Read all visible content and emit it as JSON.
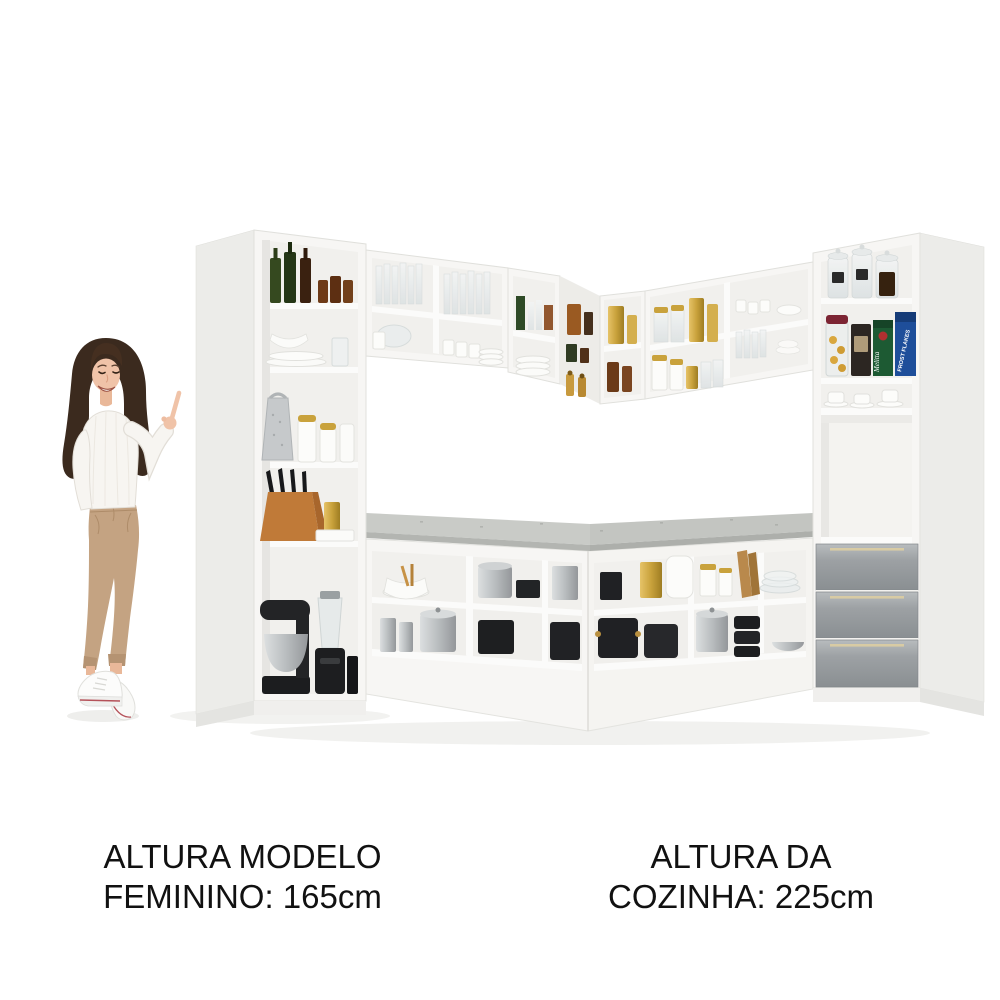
{
  "captions": {
    "model": {
      "line1": "ALTURA MODELO",
      "line2": "FEMININO: 165cm"
    },
    "kitchen": {
      "line1": "ALTURA DA",
      "line2": "COZINHA: 225cm"
    }
  },
  "product_labels": {
    "cereal_box": "FROST FLAKES",
    "coffee_box": "Melitta"
  },
  "colors": {
    "background": "#ffffff",
    "cabinet_white": "#f7f6f4",
    "cabinet_side": "#ecece9",
    "interior": "#f2f1ee",
    "countertop_gray": "#c7c9c5",
    "drawer_gray": "#9aa0a3",
    "handle_gold": "#d8cba4",
    "accent_gold": "#c9a23c",
    "text": "#111111"
  },
  "scene": {
    "type": "product image - L-shaped corner kitchen with open shelves and female model pointing",
    "areas": {
      "left_pantry": [
        "glass bottles",
        "small amber jars",
        "plates and bowls",
        "drinking glass",
        "metal grater",
        "canisters with gold lids",
        "knife block with knives",
        "gold canister",
        "serving tray",
        "stand mixer",
        "blender",
        "black appliance"
      ],
      "wall_cabinets": [
        "drinking glasses",
        "glass bowl",
        "white mugs",
        "stacked plates",
        "amber and green glasses",
        "gold canisters",
        "spice grinders",
        "glass jars with gold lids",
        "white canisters with gold lids"
      ],
      "right_tall_cabinet": [
        "glass storage jars with labels",
        "cookie jar",
        "coffee bag",
        "Melitta coffee box",
        "Frost Flakes cereal box",
        "cups and saucers",
        "open niche",
        "three gray drawers with gold handles"
      ],
      "base_counters": [
        "white bowl with utensils",
        "stainless pots",
        "black stock pots",
        "gold box",
        "white pitcher",
        "wooden cutting boards",
        "glass plates",
        "stainless bowl",
        "silver canisters"
      ]
    }
  }
}
